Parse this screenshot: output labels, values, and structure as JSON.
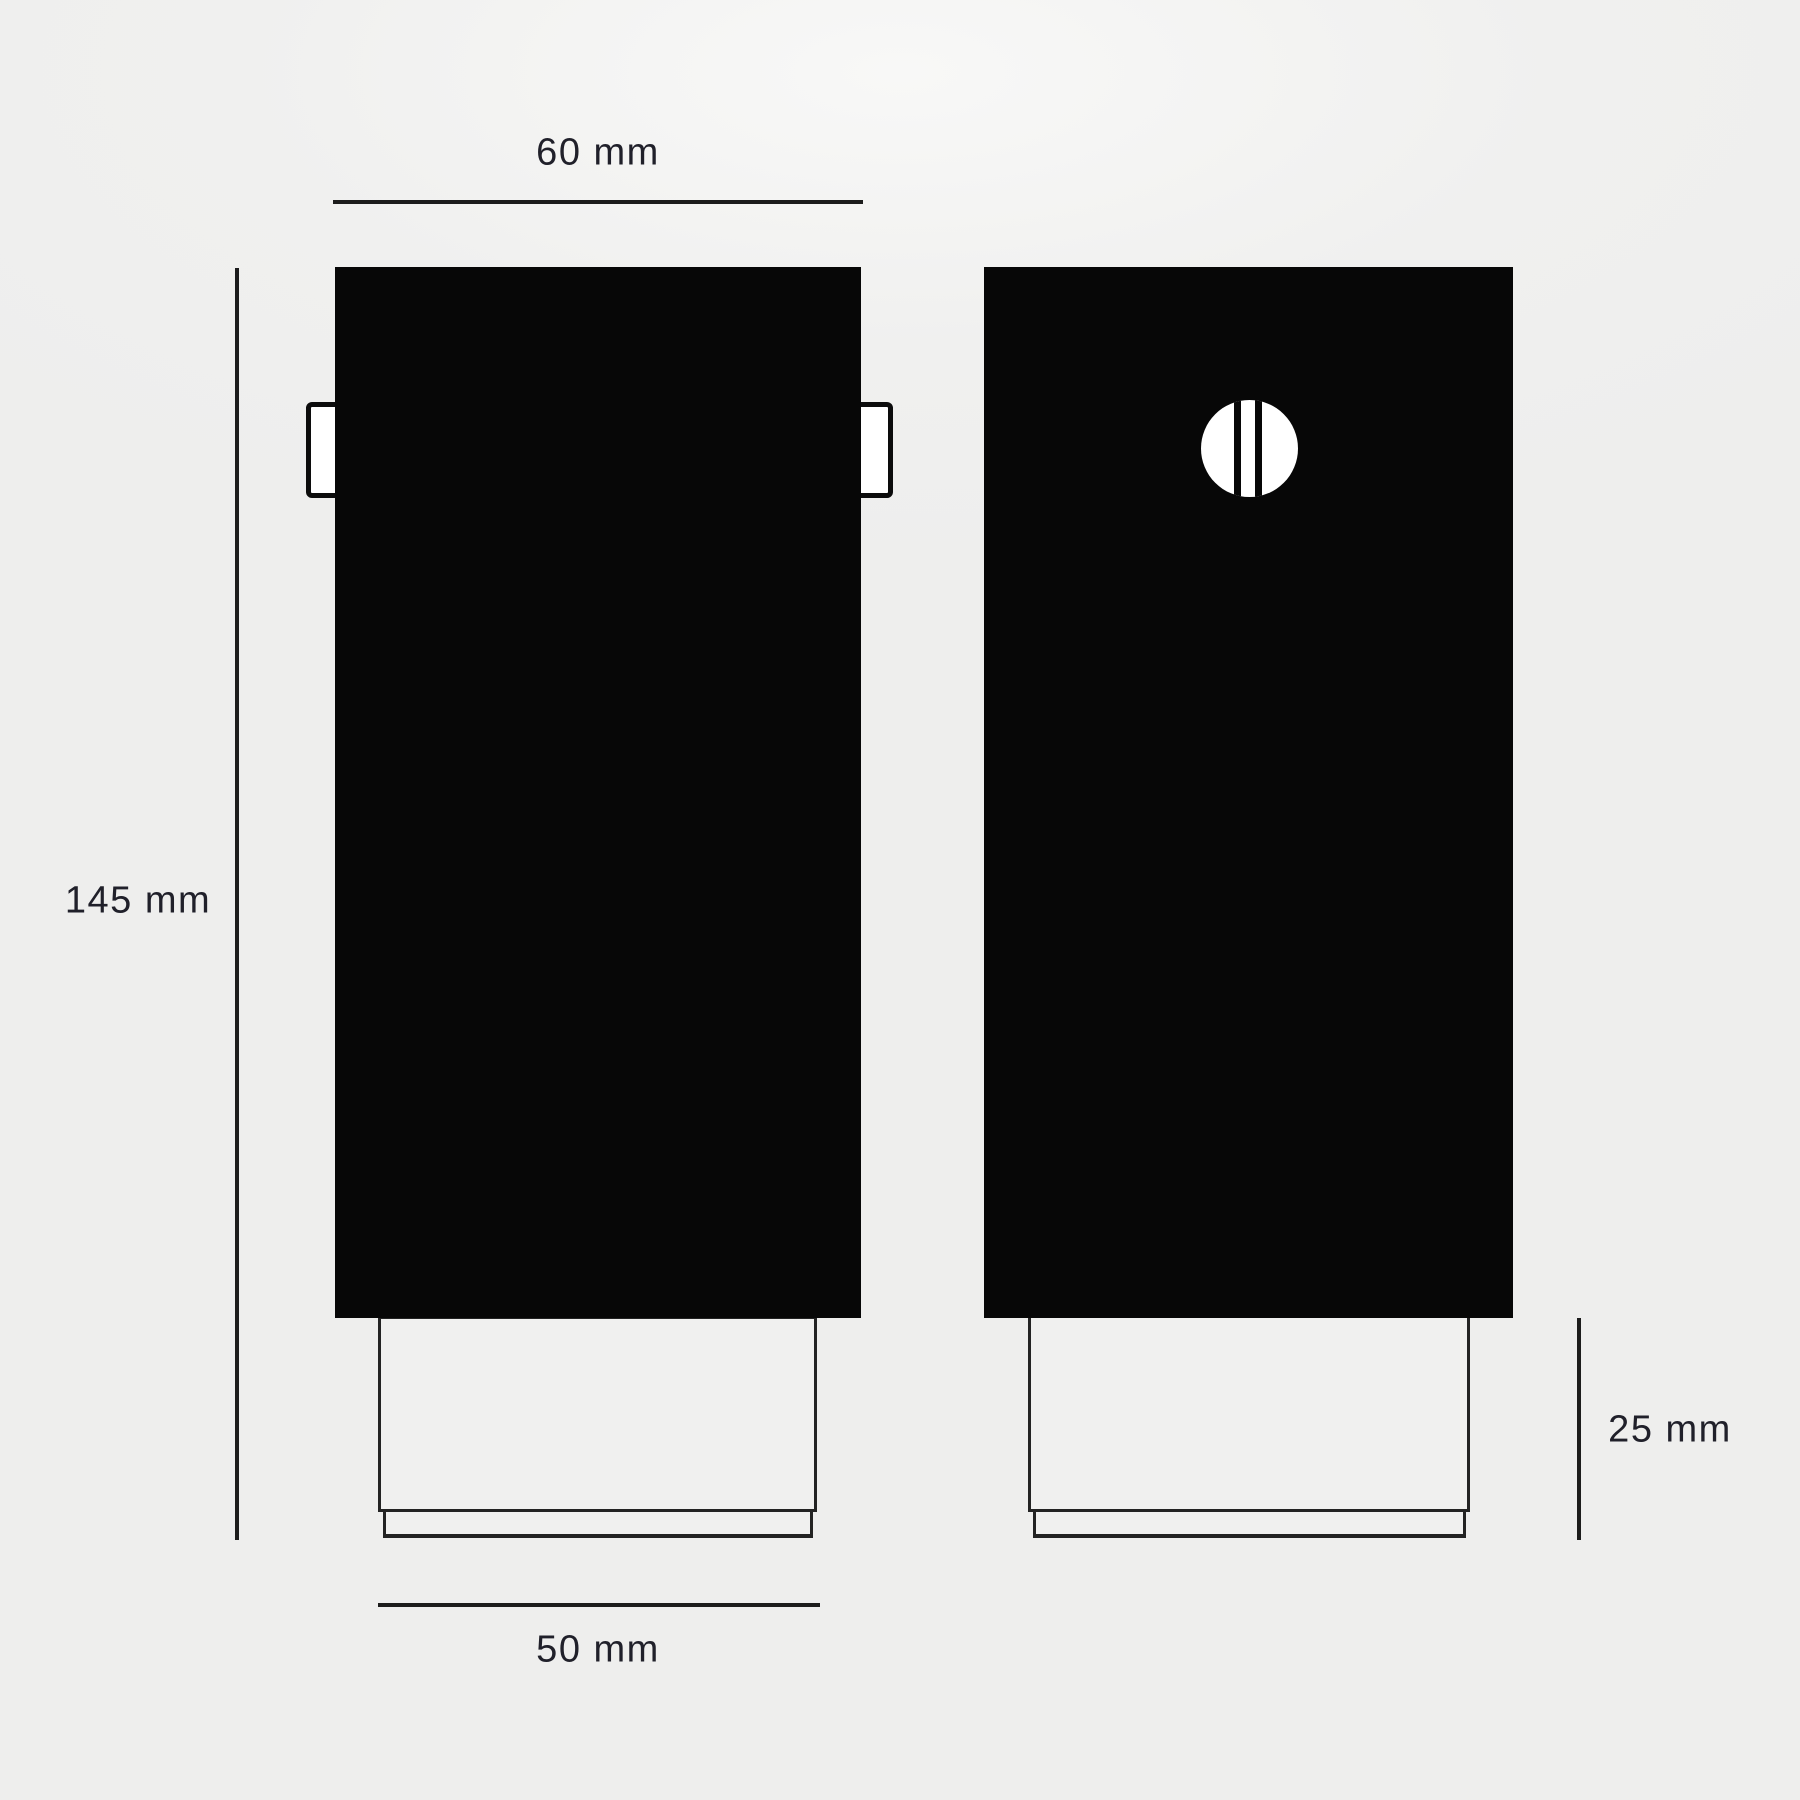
{
  "diagram": {
    "type": "technical-dimension-drawing",
    "views": {
      "front": "front elevation with side mounting tabs",
      "back": "rear elevation with slotted screw head"
    },
    "dimensions": {
      "overall_width": {
        "label": "60 mm"
      },
      "overall_height": {
        "label": "145 mm"
      },
      "base_width": {
        "label": "50 mm"
      },
      "base_height": {
        "label": "25 mm"
      }
    },
    "icons": {
      "screw_head": "screw-head-slot-icon"
    },
    "colors": {
      "background": "#eeeeed",
      "body_fill": "#070707",
      "dimension_line": "#1c1c1c",
      "label_text": "#20202a",
      "base_outline": "#232323",
      "screw_fill": "#ffffff"
    }
  }
}
